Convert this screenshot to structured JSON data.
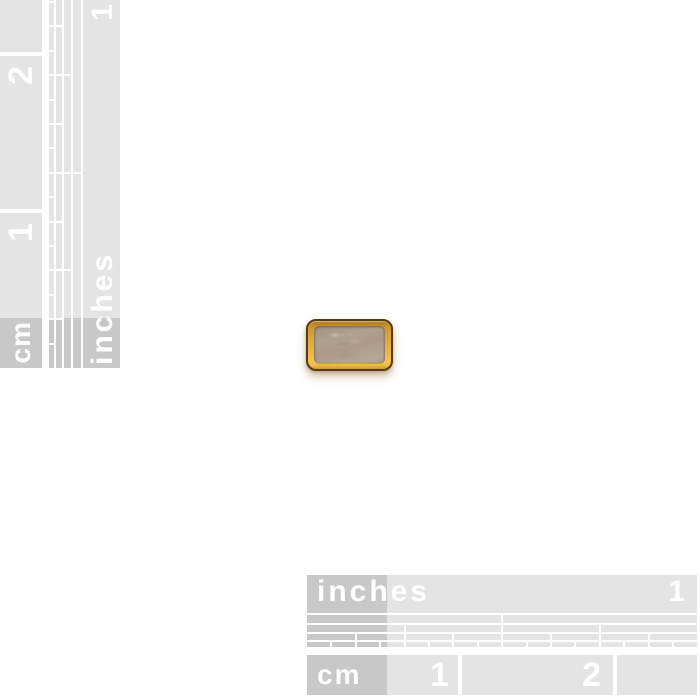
{
  "colors": {
    "bg": "#ffffff",
    "ruler_light": "#e4e4e4",
    "ruler_dark": "#c8c8c8",
    "ruler_line": "#ffffff",
    "ruler_text": "#ffffff",
    "gold_dark": "#cf9730",
    "gold_mid": "#dda63c",
    "gold_bright": "#f2c452",
    "outline_brown": "#58390f",
    "lid_tan": "#b1a08f",
    "lid_tan_light": "#b7a795"
  },
  "left_ruler": {
    "inches_label": "inches",
    "cm_label": "cm",
    "inch_numbers": [
      "1"
    ],
    "cm_numbers": [
      "1",
      "2"
    ]
  },
  "bottom_ruler": {
    "inches_label": "inches",
    "cm_label": "cm",
    "inch_numbers": [
      "1"
    ],
    "cm_numbers": [
      "1",
      "2"
    ]
  }
}
